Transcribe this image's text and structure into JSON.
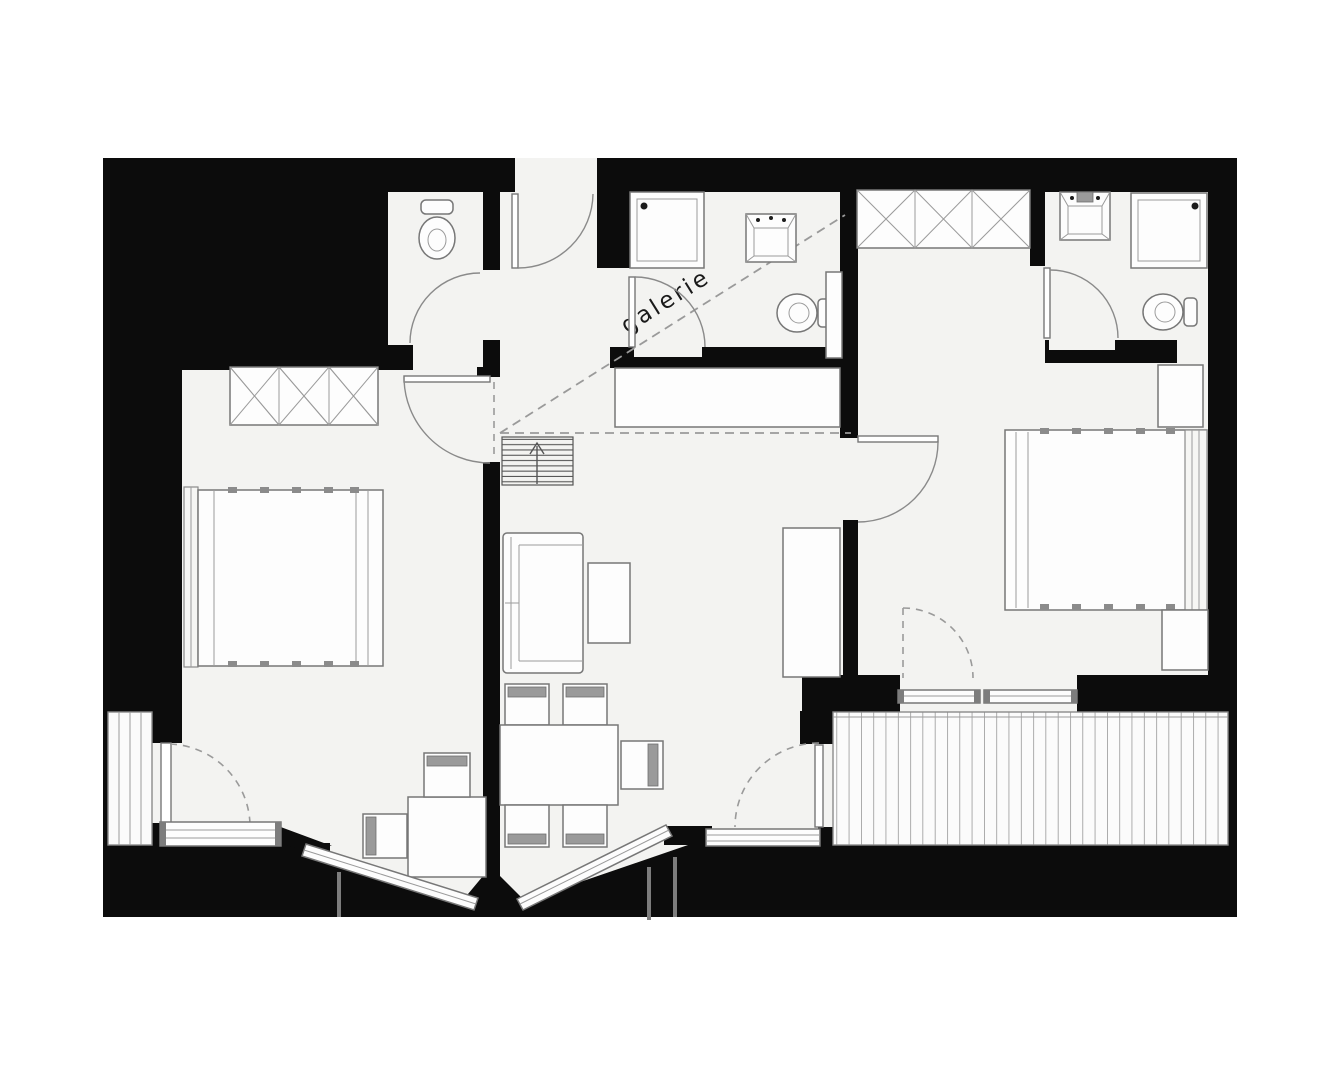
{
  "plan": {
    "type": "apartment-floor-plan",
    "label_galerie": "galerie",
    "colors": {
      "wall": "#0c0c0c",
      "floor": "#f3f3f1",
      "furniture_line": "#777777",
      "dashed_line": "#9a9a9a",
      "label_text": "#1a1a1a",
      "background": "#ffffff"
    },
    "fixtures": [
      "toilet",
      "shower",
      "sink",
      "wardrobe",
      "double-bed",
      "nightstand",
      "sofa",
      "coffee-table",
      "dining-table",
      "chair",
      "desk",
      "stairs",
      "kitchen-counter",
      "sideboard",
      "deck",
      "balcony",
      "door-swing",
      "window"
    ]
  }
}
